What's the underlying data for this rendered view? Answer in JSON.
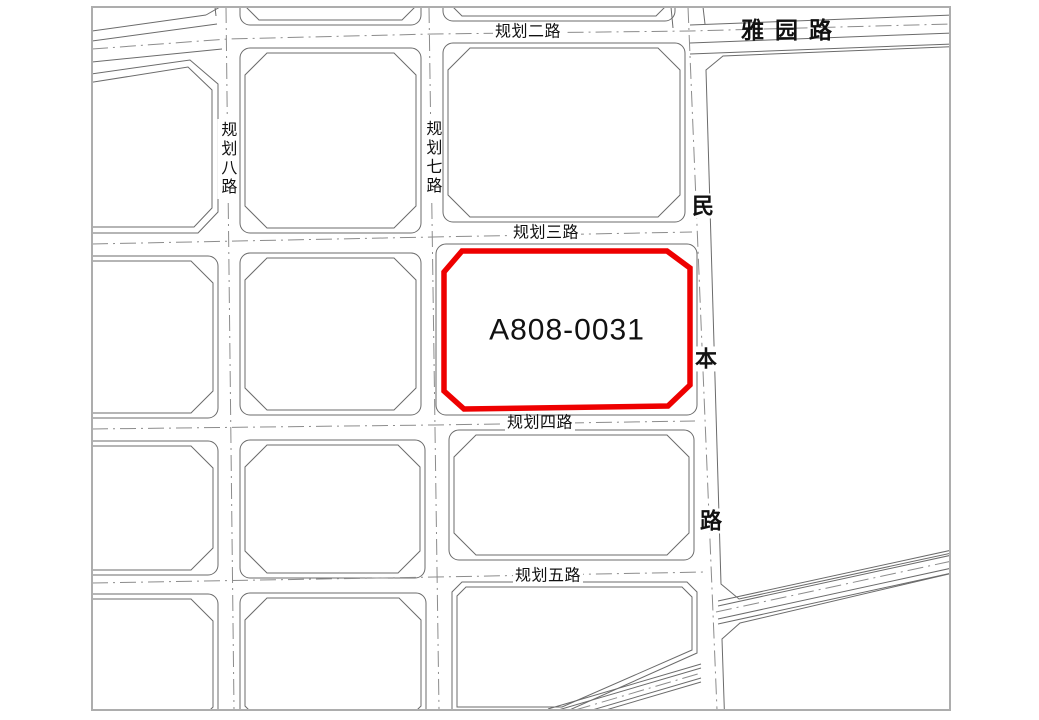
{
  "map": {
    "parcel": {
      "id": "A808-0031",
      "outline_color": "#ee0000"
    },
    "roads": {
      "guihua2": "规划二路",
      "yayuan": "雅园路",
      "guihua8": "规划八路",
      "guihua7": "规划七路",
      "guihua3": "规划三路",
      "guihua4": "规划四路",
      "guihua5": "规划五路",
      "minben": "民本路",
      "minben_chars": [
        "民",
        "本",
        "路"
      ]
    },
    "line_colors": {
      "road_edge": "#6b6b6b",
      "centerline": "#8c8c8c",
      "frame": "#adadad"
    }
  }
}
